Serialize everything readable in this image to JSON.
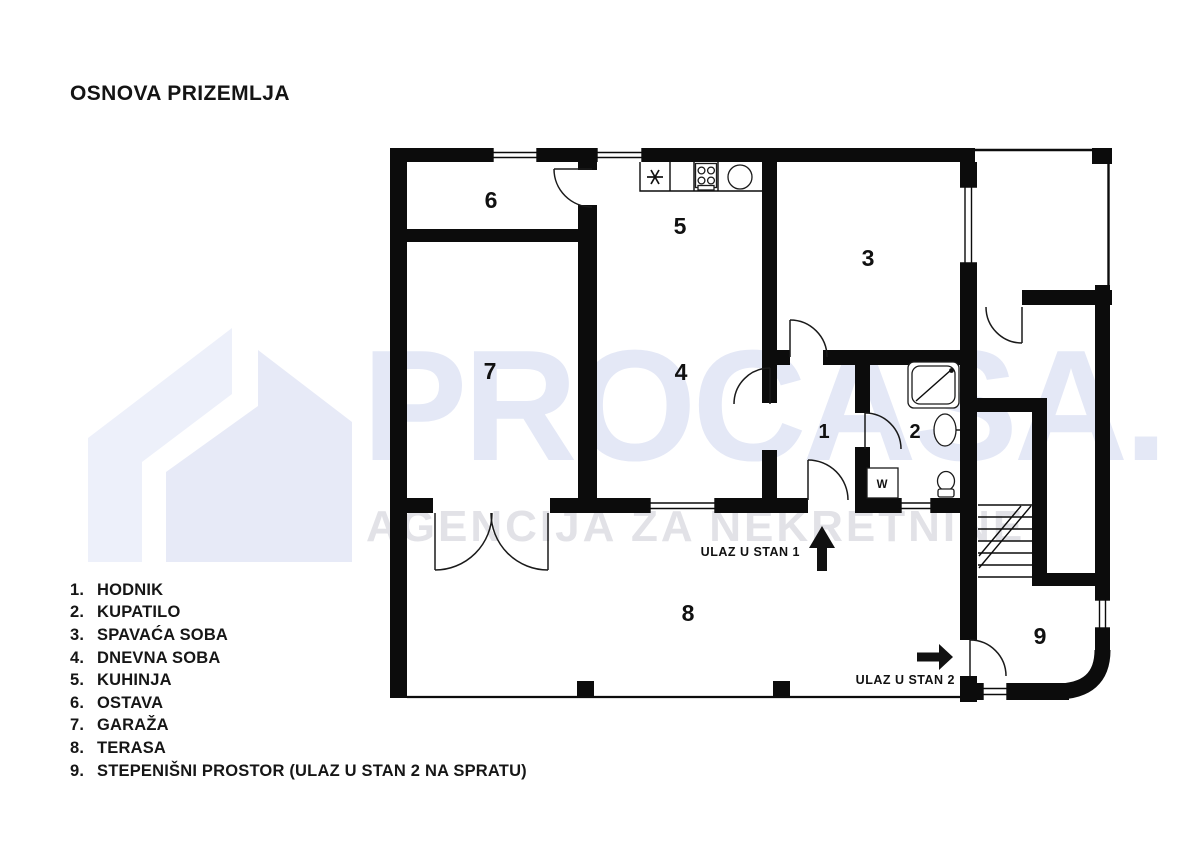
{
  "title": "OSNOVA PRIZEMLJA",
  "legend": {
    "items": [
      {
        "num": "1.",
        "label": "HODNIK"
      },
      {
        "num": "2.",
        "label": "KUPATILO"
      },
      {
        "num": "3.",
        "label": "SPAVAĆA SOBA"
      },
      {
        "num": "4.",
        "label": "DNEVNA SOBA"
      },
      {
        "num": "5.",
        "label": "KUHINJA"
      },
      {
        "num": "6.",
        "label": "OSTAVA"
      },
      {
        "num": "7.",
        "label": "GARAŽA"
      },
      {
        "num": "8.",
        "label": "TERASA"
      },
      {
        "num": "9.",
        "label": "STEPENIŠNI PROSTOR (ULAZ U STAN 2 NA SPRATU)"
      }
    ]
  },
  "plan": {
    "room_labels": [
      {
        "name": "hodnik",
        "number": "1"
      },
      {
        "name": "kupatilo",
        "number": "2"
      },
      {
        "name": "spavaca-soba",
        "number": "3"
      },
      {
        "name": "dnevna-soba",
        "number": "4"
      },
      {
        "name": "kuhinja",
        "number": "5"
      },
      {
        "name": "ostava",
        "number": "6"
      },
      {
        "name": "garaza",
        "number": "7"
      },
      {
        "name": "terasa",
        "number": "8"
      },
      {
        "name": "stepenisni-prostor",
        "number": "9"
      }
    ],
    "entrance1_label": "ULAZ U STAN 1",
    "entrance2_label": "ULAZ U STAN 2",
    "washer_label": "W"
  },
  "watermark": {
    "brand": "PROCASA.",
    "monogram": "R",
    "tagline": "AGENCIJA ZA NEKRETNINE"
  },
  "icons": {
    "house_logo": "css-polygon-shape",
    "stove": "svg-4-burners",
    "kitchen_sink": "svg-circle",
    "boiler_asterisk": "svg-asterisk-lines",
    "shower": "svg-rounded-square-diagonal",
    "bath_sink": "svg-oval",
    "toilet": "svg-bowl",
    "stairs": "svg-treads",
    "arrow_up": "svg-solid-arrow",
    "arrow_right": "svg-solid-arrow"
  },
  "colors": {
    "wall": "#0c0c0c",
    "watermark_lavender": "#e5e8f6",
    "watermark_gray": "#e2e2e7",
    "background": "#ffffff"
  }
}
